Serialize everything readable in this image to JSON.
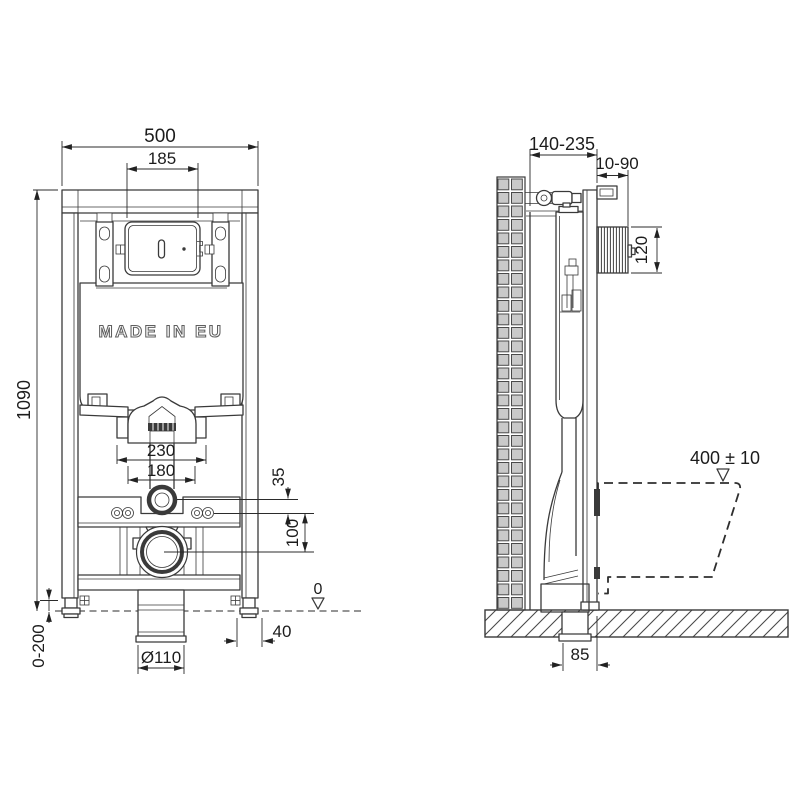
{
  "drawing": {
    "made_in_label": "MADE IN EU",
    "front_view": {
      "frame_width": "500",
      "plate_cutout_width": "185",
      "frame_height": "1090",
      "foot_adjustment": "0-200",
      "fixing_span_outer": "230",
      "fixing_span_inner": "180",
      "inlet_offset": "35",
      "drain_offset": "100",
      "floor_level": "0",
      "foot_depth": "40",
      "drain_diameter": "Ø110"
    },
    "side_view": {
      "frame_depth": "140-235",
      "finished_wall_range": "10-90",
      "plate_box_height": "120",
      "bowl_rim_height": "400 ± 10",
      "drain_axis_offset": "85"
    },
    "colors": {
      "line": "#3a3a3a",
      "dimension": "#2b2b2b",
      "tile_fill": "#c9c9c9",
      "background": "#ffffff"
    }
  }
}
